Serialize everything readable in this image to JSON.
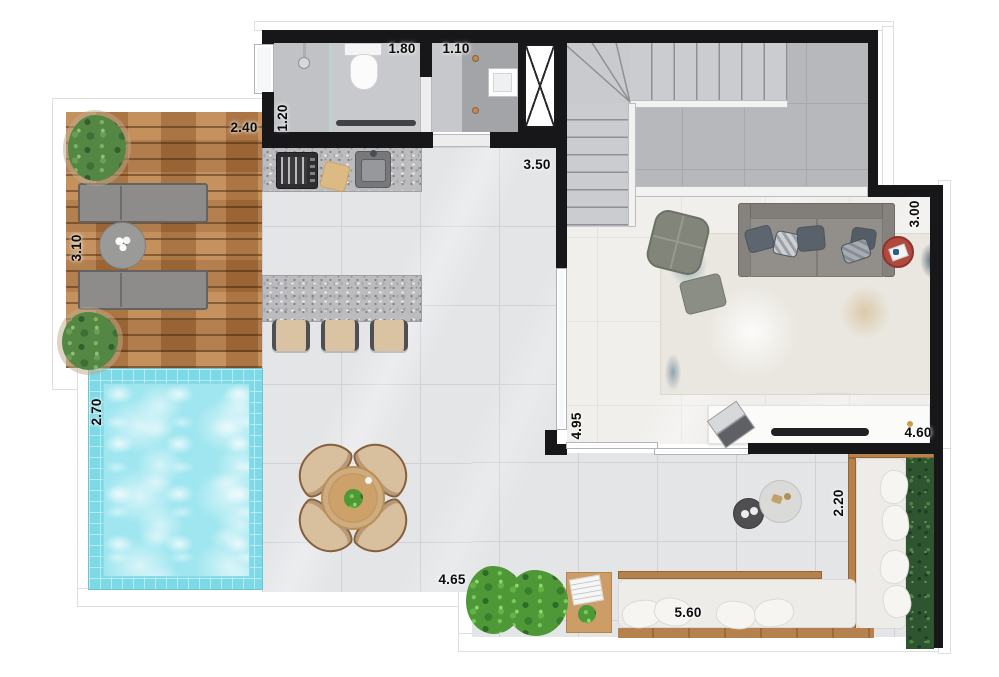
{
  "plan": {
    "type": "apartment-floor-plan-top-view",
    "dimensions": {
      "deck_width": "2.40",
      "deck_depth": "3.10",
      "bathroom_depth": "1.20",
      "bathroom_width": "1.80",
      "laundry_width": "1.10",
      "hall_width": "3.50",
      "living_depth": "3.00",
      "pool_depth": "2.70",
      "glass_wall_length": "4.95",
      "tv_wall_length": "4.60",
      "terrace_depth": "2.20",
      "terrace_left_width": "4.65",
      "terrace_bench_length": "5.60"
    },
    "colors": {
      "wall": "#171719",
      "pool_water": "#9fe6f0",
      "pool_tile": "#7cd9e5",
      "wood_deck": "#b07845",
      "floor_tile": "#e4e5e7",
      "living_floor": "#f0efec",
      "stair_floor": "#b7b8bc",
      "granite_counter": "#bcbcbe",
      "sofa": "#8d8a85",
      "armchair_olive": "#82867a",
      "rug_blue": "#5e889e",
      "red_side_table": "#b2493f",
      "bench_cushion": "#eeece9",
      "bench_wood": "#b5824d",
      "hedge_green": "#2f5430",
      "plant_green": "#4e9838",
      "stool_tan": "#d9c3a3"
    },
    "objects": [
      "wood-deck",
      "sun-loungers",
      "deck-table",
      "potted-plants",
      "pool",
      "kitchen-counter",
      "cooktop",
      "sink",
      "cutting-board",
      "kitchen-island",
      "bar-stools",
      "bathroom",
      "shower",
      "toilet",
      "towel-bar",
      "laundry-basin",
      "duct-shaft",
      "staircase",
      "living-sofa",
      "armchair",
      "ottoman",
      "area-rug",
      "red-tray-table",
      "tv-console",
      "tv",
      "laptop",
      "dining-table",
      "dining-chairs",
      "terrace-bench",
      "bench-pillows",
      "hedge",
      "coffee-tables",
      "side-table",
      "terrace-plants",
      "sliding-glass-doors"
    ]
  }
}
